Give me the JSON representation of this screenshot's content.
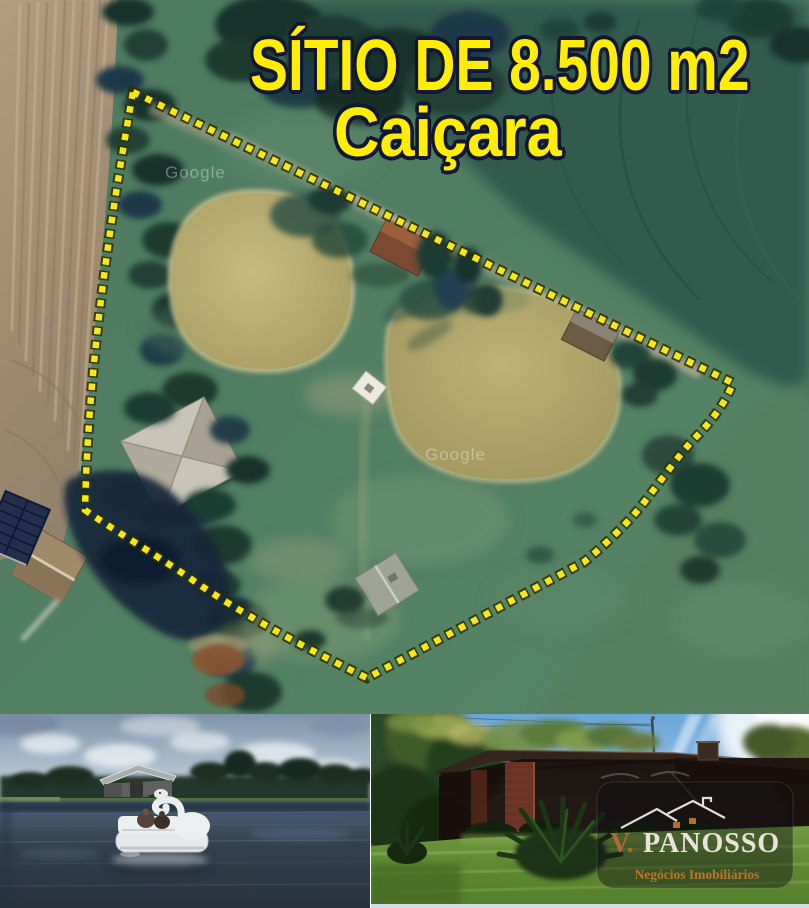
{
  "title": {
    "line1": "SÍTIO DE 8.500 m2",
    "line2": "Caiçara",
    "text_color": "#ffee00",
    "outline_color": "#131633"
  },
  "satellite_map": {
    "watermark": "Google",
    "boundary_color": "#f5e813",
    "boundary_style": "dotted-square",
    "features": [
      "plowed-field",
      "tree-line",
      "pond-1",
      "pond-2",
      "main-house",
      "red-roof-shed",
      "brown-roof-shed",
      "grey-roof-shed",
      "barn",
      "solar-panels",
      "dark-pond",
      "dirt-patch",
      "white-deck"
    ]
  },
  "photos": {
    "left": {
      "subjects": [
        "sky",
        "clouds",
        "tree-line",
        "barn",
        "swan-pedal-boat",
        "pond-water"
      ]
    },
    "right": {
      "subjects": [
        "sky",
        "sun-flare",
        "trees",
        "brick-house",
        "veranda",
        "foreground-plant",
        "lawn"
      ],
      "watermark_logo": {
        "prefix": "V.",
        "name": "PANOSSO",
        "tagline": "Negócios Imobiliários",
        "prefix_color": "#b06a32",
        "name_color": "#e9e4d8",
        "tagline_color": "#c07a28",
        "background": "rgba(12,12,16,0.42)"
      }
    }
  }
}
